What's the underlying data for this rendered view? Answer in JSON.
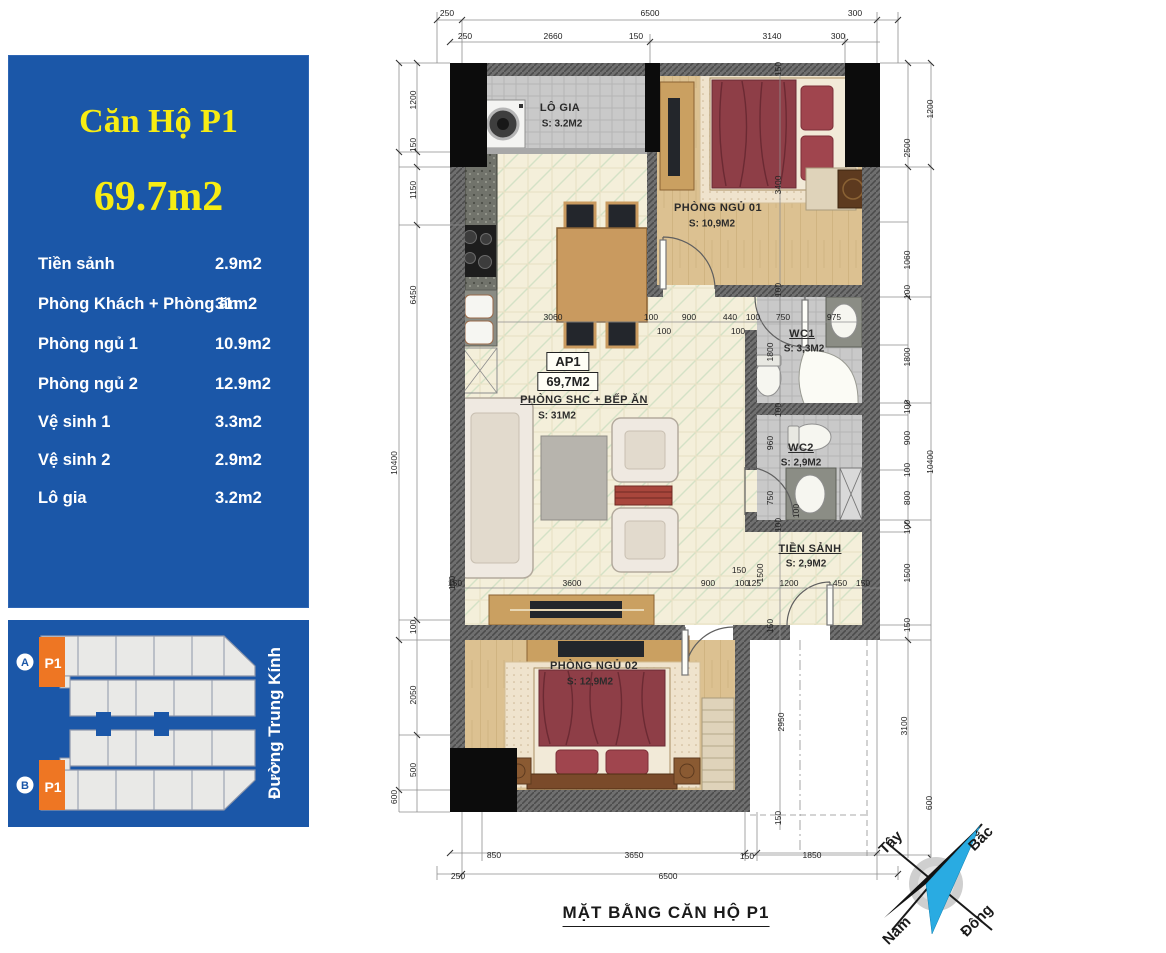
{
  "info_panel": {
    "title": "Căn Hộ P1",
    "total_area": "69.7m2",
    "rooms": [
      {
        "label": "Tiền sảnh",
        "value": "2.9m2"
      },
      {
        "label": "Phòng Khách + Phòng ăn",
        "value": "31m2"
      },
      {
        "label": "Phòng ngủ 1",
        "value": "10.9m2"
      },
      {
        "label": "Phòng ngủ 2",
        "value": "12.9m2"
      },
      {
        "label": "Vệ sinh 1",
        "value": "3.3m2"
      },
      {
        "label": "Vệ sinh 2",
        "value": "2.9m2"
      },
      {
        "label": "Lô gia",
        "value": "3.2m2"
      }
    ],
    "colors": {
      "bg": "#1b57a8",
      "accent": "#f7ec13",
      "text": "#ffffff"
    }
  },
  "site_map": {
    "marker_a": "A",
    "marker_b": "B",
    "unit_label_a": "P1",
    "unit_label_b": "P1",
    "street": "Đường Trung Kính",
    "colors": {
      "bg": "#1b57a8",
      "unit": "#ee7623",
      "block": "#e9e9e7"
    }
  },
  "floor_plan": {
    "caption": "MẶT BẰNG CĂN HỘ P1",
    "unit_code": "AP1",
    "unit_area": "69,7M2",
    "rooms": [
      {
        "name": "LÔ GIA",
        "area": "S: 3.2M2"
      },
      {
        "name": "PHÒNG NGỦ 01",
        "area": "S: 10,9M2"
      },
      {
        "name": "PHÒNG SHC + BẾP ĂN",
        "area": "S: 31M2"
      },
      {
        "name": "WC1",
        "area": "S: 3,3M2"
      },
      {
        "name": "WC2",
        "area": "S: 2,9M2"
      },
      {
        "name": "TIỀN SẢNH",
        "area": "S: 2,9M2"
      },
      {
        "name": "PHÒNG NGỦ 02",
        "area": "S: 12,9M2"
      }
    ],
    "compass": {
      "north": "Bắc",
      "south": "Nam",
      "west": "Tây",
      "east": "Đông"
    },
    "dim_labels": [
      {
        "t": "250",
        "x": 447,
        "y": 13,
        "r": 0,
        "g": "top-outer"
      },
      {
        "t": "6500",
        "x": 650,
        "y": 13,
        "r": 0,
        "g": "top-outer"
      },
      {
        "t": "300",
        "x": 855,
        "y": 13,
        "r": 0,
        "g": "top-outer"
      },
      {
        "t": "250",
        "x": 465,
        "y": 36,
        "r": 0,
        "g": "top-inner"
      },
      {
        "t": "2660",
        "x": 553,
        "y": 36,
        "r": 0,
        "g": "top-inner"
      },
      {
        "t": "150",
        "x": 636,
        "y": 36,
        "r": 0,
        "g": "top-inner"
      },
      {
        "t": "3140",
        "x": 772,
        "y": 36,
        "r": 0,
        "g": "top-inner"
      },
      {
        "t": "300",
        "x": 838,
        "y": 36,
        "r": 0,
        "g": "top-inner"
      },
      {
        "t": "850",
        "x": 494,
        "y": 855,
        "r": 0,
        "g": "bottom-inner"
      },
      {
        "t": "3650",
        "x": 634,
        "y": 855,
        "r": 0,
        "g": "bottom-inner"
      },
      {
        "t": "150",
        "x": 747,
        "y": 856,
        "r": 0,
        "g": "bottom-inner"
      },
      {
        "t": "1850",
        "x": 812,
        "y": 855,
        "r": 0,
        "g": "bottom-inner"
      },
      {
        "t": "250",
        "x": 458,
        "y": 876,
        "r": 0,
        "g": "bottom-outer"
      },
      {
        "t": "6500",
        "x": 668,
        "y": 876,
        "r": 0,
        "g": "bottom-outer"
      },
      {
        "t": "10400",
        "x": 394,
        "y": 463,
        "r": 1,
        "g": "left-outer"
      },
      {
        "t": "600",
        "x": 394,
        "y": 797,
        "r": 1,
        "g": "left-outer"
      },
      {
        "t": "1200",
        "x": 413,
        "y": 100,
        "r": 1,
        "g": "left-inner"
      },
      {
        "t": "150",
        "x": 413,
        "y": 145,
        "r": 1,
        "g": "left-inner"
      },
      {
        "t": "1150",
        "x": 413,
        "y": 190,
        "r": 1,
        "g": "left-inner"
      },
      {
        "t": "6450",
        "x": 413,
        "y": 295,
        "r": 1,
        "g": "left-inner"
      },
      {
        "t": "100",
        "x": 413,
        "y": 627,
        "r": 1,
        "g": "left-inner"
      },
      {
        "t": "2050",
        "x": 413,
        "y": 695,
        "r": 1,
        "g": "left-inner"
      },
      {
        "t": "500",
        "x": 413,
        "y": 770,
        "r": 1,
        "g": "left-inner"
      },
      {
        "t": "150",
        "x": 452,
        "y": 583,
        "r": 1,
        "g": "left-inside"
      },
      {
        "t": "2500",
        "x": 907,
        "y": 148,
        "r": 1,
        "g": "right-inner"
      },
      {
        "t": "1060",
        "x": 907,
        "y": 260,
        "r": 1,
        "g": "right-inner"
      },
      {
        "t": "100",
        "x": 907,
        "y": 292,
        "r": 1,
        "g": "right-inner"
      },
      {
        "t": "1800",
        "x": 907,
        "y": 357,
        "r": 1,
        "g": "right-inner"
      },
      {
        "t": "100",
        "x": 907,
        "y": 407,
        "r": 1,
        "g": "right-inner"
      },
      {
        "t": "900",
        "x": 907,
        "y": 438,
        "r": 1,
        "g": "right-inner"
      },
      {
        "t": "100",
        "x": 907,
        "y": 470,
        "r": 1,
        "g": "right-inner"
      },
      {
        "t": "800",
        "x": 907,
        "y": 498,
        "r": 1,
        "g": "right-inner"
      },
      {
        "t": "100",
        "x": 907,
        "y": 527,
        "r": 1,
        "g": "right-inner"
      },
      {
        "t": "1500",
        "x": 907,
        "y": 573,
        "r": 1,
        "g": "right-inner"
      },
      {
        "t": "150",
        "x": 907,
        "y": 625,
        "r": 1,
        "g": "right-inner"
      },
      {
        "t": "3100",
        "x": 904,
        "y": 726,
        "r": 1,
        "g": "right-inner"
      },
      {
        "t": "1200",
        "x": 930,
        "y": 109,
        "r": 1,
        "g": "right-outer"
      },
      {
        "t": "10400",
        "x": 930,
        "y": 462,
        "r": 1,
        "g": "right-outer"
      },
      {
        "t": "600",
        "x": 929,
        "y": 803,
        "r": 1,
        "g": "right-outer"
      },
      {
        "t": "3060",
        "x": 553,
        "y": 317,
        "r": 0,
        "g": "row-a"
      },
      {
        "t": "100",
        "x": 651,
        "y": 317,
        "r": 0,
        "g": "row-a"
      },
      {
        "t": "900",
        "x": 689,
        "y": 317,
        "r": 0,
        "g": "row-a"
      },
      {
        "t": "440",
        "x": 730,
        "y": 317,
        "r": 0,
        "g": "row-a"
      },
      {
        "t": "100",
        "x": 753,
        "y": 317,
        "r": 0,
        "g": "row-a"
      },
      {
        "t": "750",
        "x": 783,
        "y": 317,
        "r": 0,
        "g": "row-a"
      },
      {
        "t": "975",
        "x": 834,
        "y": 317,
        "r": 0,
        "g": "row-a"
      },
      {
        "t": "100",
        "x": 664,
        "y": 331,
        "r": 0,
        "g": "row-a2"
      },
      {
        "t": "100",
        "x": 738,
        "y": 331,
        "r": 0,
        "g": "row-a2"
      },
      {
        "t": "150",
        "x": 455,
        "y": 583,
        "r": 0,
        "g": "row-b"
      },
      {
        "t": "3600",
        "x": 572,
        "y": 583,
        "r": 0,
        "g": "row-b"
      },
      {
        "t": "900",
        "x": 708,
        "y": 583,
        "r": 0,
        "g": "row-b"
      },
      {
        "t": "100",
        "x": 742,
        "y": 583,
        "r": 0,
        "g": "row-b"
      },
      {
        "t": "125",
        "x": 754,
        "y": 583,
        "r": 0,
        "g": "row-b"
      },
      {
        "t": "1200",
        "x": 789,
        "y": 583,
        "r": 0,
        "g": "row-b"
      },
      {
        "t": "450",
        "x": 840,
        "y": 583,
        "r": 0,
        "g": "row-b"
      },
      {
        "t": "150",
        "x": 863,
        "y": 583,
        "r": 0,
        "g": "row-b"
      },
      {
        "t": "150",
        "x": 739,
        "y": 570,
        "r": 0,
        "g": "row-b2"
      },
      {
        "t": "1500",
        "x": 760,
        "y": 573,
        "r": 1,
        "g": "hall-v"
      },
      {
        "t": "150",
        "x": 770,
        "y": 626,
        "r": 1,
        "g": "hall-v"
      },
      {
        "t": "150",
        "x": 778,
        "y": 69,
        "r": 1,
        "g": "bed1-v"
      },
      {
        "t": "3400",
        "x": 778,
        "y": 185,
        "r": 1,
        "g": "bed1-v"
      },
      {
        "t": "100",
        "x": 778,
        "y": 290,
        "r": 1,
        "g": "bed1-v"
      },
      {
        "t": "1800",
        "x": 770,
        "y": 352,
        "r": 1,
        "g": "wc-v"
      },
      {
        "t": "100",
        "x": 778,
        "y": 410,
        "r": 1,
        "g": "wc-v"
      },
      {
        "t": "960",
        "x": 770,
        "y": 443,
        "r": 1,
        "g": "wc-v"
      },
      {
        "t": "750",
        "x": 770,
        "y": 498,
        "r": 1,
        "g": "wc-v"
      },
      {
        "t": "100",
        "x": 796,
        "y": 511,
        "r": 1,
        "g": "wc-v"
      },
      {
        "t": "100",
        "x": 778,
        "y": 525,
        "r": 1,
        "g": "wc-v"
      },
      {
        "t": "2950",
        "x": 781,
        "y": 722,
        "r": 1,
        "g": "bed2-v"
      },
      {
        "t": "150",
        "x": 778,
        "y": 818,
        "r": 1,
        "g": "bed2-v"
      }
    ]
  }
}
